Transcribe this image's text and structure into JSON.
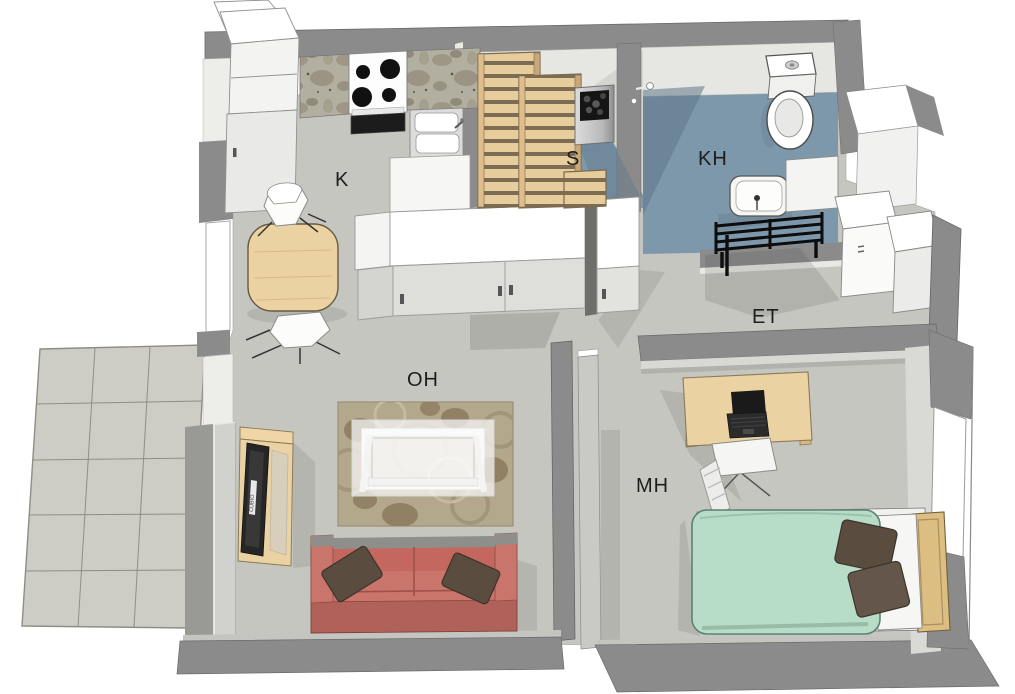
{
  "scene": {
    "type": "3d-floor-plan-rendering",
    "background": "#ffffff",
    "width": 1015,
    "height": 694
  },
  "rooms": {
    "kitchen": {
      "label": "K"
    },
    "sauna": {
      "label": "S"
    },
    "bathroom": {
      "label": "KH"
    },
    "entry": {
      "label": "ET"
    },
    "living_room": {
      "label": "OH"
    },
    "bedroom": {
      "label": "MH"
    }
  },
  "furniture": {
    "kitchen": [
      "tall-cabinets",
      "marble-counter",
      "stove",
      "oven",
      "sink",
      "dining-table",
      "chairs"
    ],
    "sauna": [
      "sauna-bench",
      "sauna-bench-high",
      "sauna-stool",
      "sauna-heater"
    ],
    "bathroom": [
      "toilet",
      "washbasin",
      "shower-mixer",
      "towel-rack",
      "cabinet"
    ],
    "entry": [
      "wardrobe",
      "wardrobe",
      "hall-cabinet-row"
    ],
    "living_room": [
      "area-rug",
      "coffee-table",
      "sofa",
      "sofa-pillows",
      "tv-stand",
      "tv"
    ],
    "bedroom": [
      "desk",
      "laptop",
      "office-chair",
      "bed",
      "bed-pillows",
      "headboard"
    ],
    "outdoor": [
      "patio-tiles"
    ]
  },
  "colors": {
    "wall": "#8b8b8b",
    "wall_face": "#e9e9e7",
    "floor": "#c6c6c0",
    "wet_floor": "#7e98ab",
    "patio": "#cdcdc5",
    "wood": "#ead2a2",
    "sofa": "#c9756c",
    "sofa_base": "#b0625a",
    "pillow": "#5a4c3f",
    "bed_cover": "#b7dcc8",
    "rug": "#b3a78c",
    "tv": "#262626",
    "label_text": "#1d1d1d"
  },
  "tv_brand_text": "CUBIO"
}
